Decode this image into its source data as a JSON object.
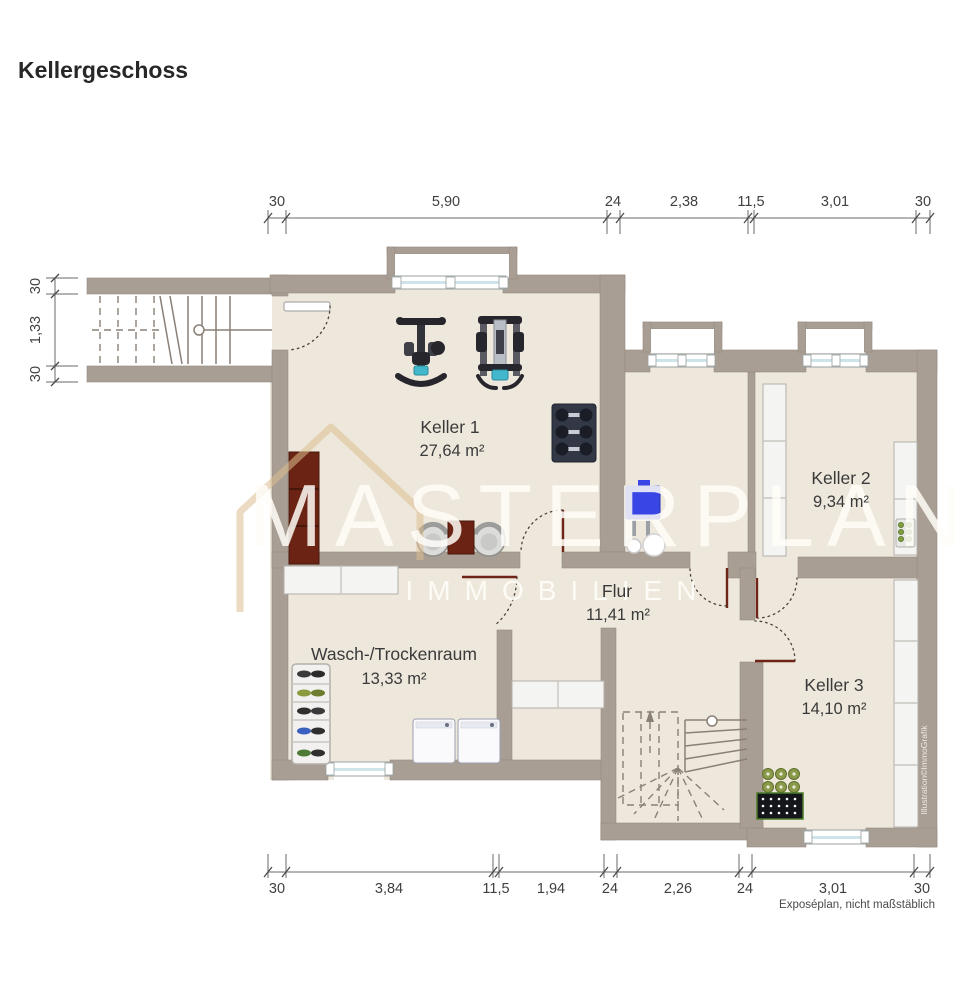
{
  "title": "Kellergeschoss",
  "plan": {
    "rooms": {
      "keller1": {
        "name": "Keller 1",
        "area": "27,64 m²"
      },
      "keller2": {
        "name": "Keller 2",
        "area": "9,34 m²"
      },
      "keller3": {
        "name": "Keller 3",
        "area": "14,10 m²"
      },
      "flur": {
        "name": "Flur",
        "area": "11,41 m²"
      },
      "wasch": {
        "name": "Wasch-/Trockenraum",
        "area": "13,33 m²"
      }
    },
    "dimensions": {
      "top": [
        "30",
        "5,90",
        "24",
        "2,38",
        "11,5",
        "3,01",
        "30"
      ],
      "bottom": [
        "30",
        "3,84",
        "11,5",
        "1,94",
        "24",
        "2,26",
        "24",
        "3,01",
        "30"
      ],
      "left": [
        "30",
        "1,33",
        "30"
      ]
    },
    "colors": {
      "wall": "#a89e93",
      "floor": "#eee8dc",
      "tank_blue": "#3a45e6",
      "pad_teal": "#43b8cc",
      "door_leaf": "#6e2517",
      "watermark_gold": "#dcbd8f"
    }
  },
  "watermark": {
    "line1": "MASTERPLAN",
    "line2": "IMMOBILIEN"
  },
  "footer": {
    "note": "Exposéplan, nicht maßstäblich",
    "credit": "Illustration©ImmoGrafik"
  }
}
